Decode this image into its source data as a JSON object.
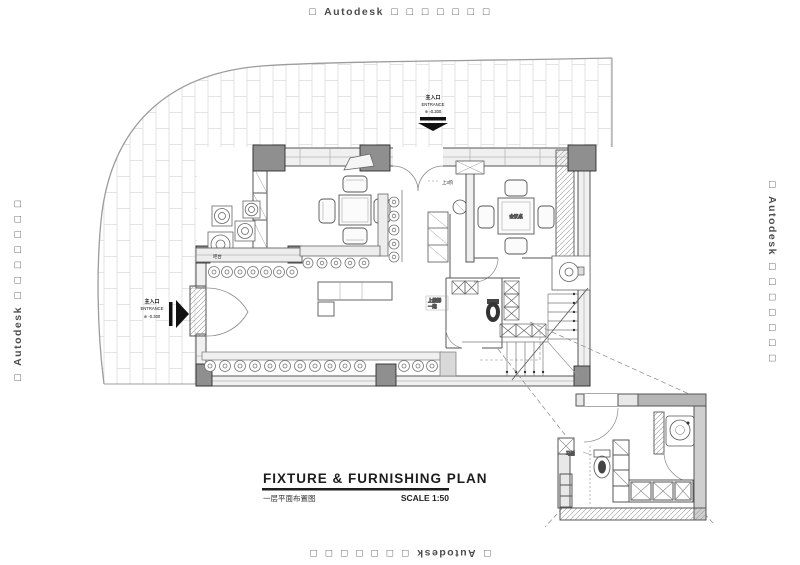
{
  "watermark": {
    "text": "□ Autodesk □ □ □ □ □ □ □"
  },
  "title_block": {
    "title": "FIXTURE & FURNISHING PLAN",
    "subtitle": "一层平面布置图",
    "scale_label": "SCALE  1:50"
  },
  "entrances": {
    "top": {
      "label_cn": "主入口",
      "label_en": "ENTRANCE",
      "level": "⊕ -0.300"
    },
    "left": {
      "label_cn": "主入口",
      "label_en": "ENTRANCE",
      "level": "⊕ -0.300"
    }
  },
  "notes": {
    "steps": "上3阶",
    "stair_line1": "上楼梯",
    "stair_line2": "一跑",
    "counter": "吧台",
    "meeting_table": "会议桌",
    "detail_toilet": "马桶"
  },
  "colors": {
    "line": "#555555",
    "light_line": "#888888",
    "wall_fill": "#ececec",
    "column_fill": "#8f8f8f",
    "tile_line": "#dcdcdc",
    "watermark": "#4d4d4d"
  }
}
